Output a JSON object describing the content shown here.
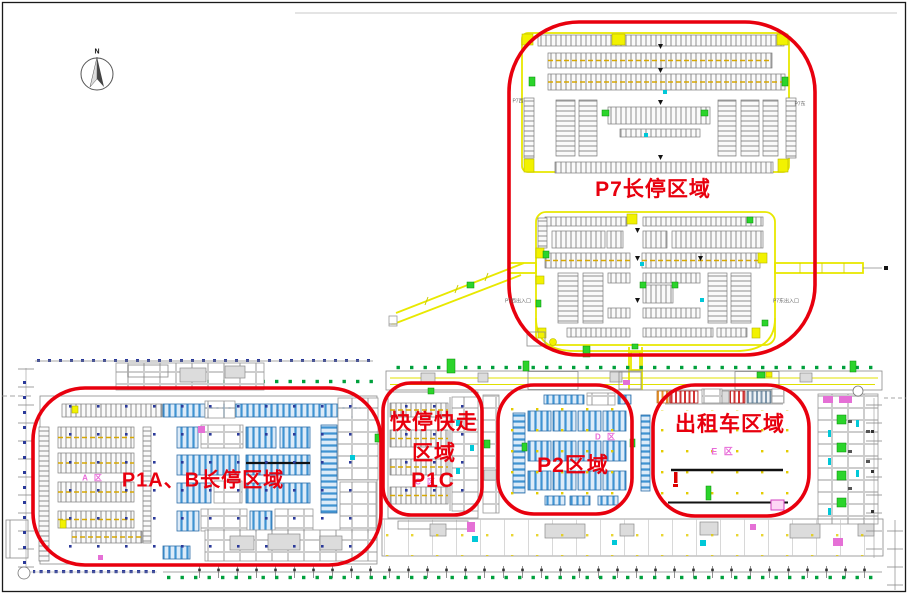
{
  "compass": {
    "north": "N"
  },
  "regions": {
    "p7": {
      "label": "P7长停区域"
    },
    "p1ab": {
      "label": "P1A、B长停区域"
    },
    "p1c": {
      "label1": "快停快走",
      "label2": "区域",
      "label3": "P1C"
    },
    "p2": {
      "label": "P2区域"
    },
    "taxi": {
      "label": "出租车区域"
    }
  },
  "zone_markers": {
    "a": "A 区",
    "c": "C 区",
    "d": "D 区",
    "e": "E 区"
  },
  "plan_texts": {
    "p7_west": "P7西",
    "p7_east": "P7东",
    "p7_west_entrance": "P7西出入口",
    "p7_east_entrance": "P7东出入口"
  },
  "colors": {
    "annotation_red": "#e8000e",
    "road_yellow": "#e8e800",
    "stall_blue": "#3f93d2",
    "stall_gray": "#8e8e8e",
    "zone_label_magenta": "#e86ad8",
    "tree_green": "#00a03c",
    "grid_dot_blue": "#2b3a9a",
    "parking_dot_yellow": "#e3cc00"
  }
}
